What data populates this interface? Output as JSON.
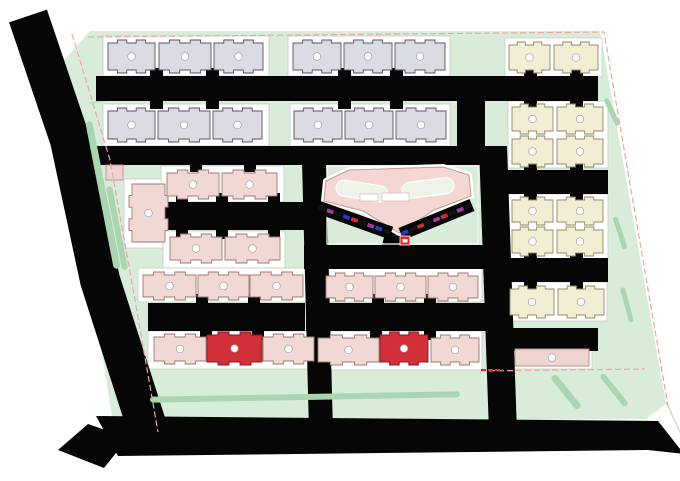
{
  "canvas": {
    "width": 680,
    "height": 481,
    "background": "#ffffff"
  },
  "palette": {
    "road": "#060606",
    "site_green": "#d9ecda",
    "hedge": "#a9d6b1",
    "hedge_light": "#c2e3c8",
    "pad_fill": "#ffffff",
    "pad_stroke": "#c9cdc9",
    "school_fill": "#f4d6d2",
    "school_stroke": "#c09a94",
    "courtyard_fill": "#edf2eb",
    "panel_frame": "#f2f6f1",
    "boundary_pink": "#e9a7a1",
    "marker_red": "#e8242b",
    "dash_red": "#e03038",
    "label_ring": "#9b9ba3"
  },
  "site": {
    "types": {
      "gray": {
        "fill": "#dbdbe3",
        "stroke": "#55555f"
      },
      "cream": {
        "fill": "#f2eed3",
        "stroke": "#8d8a68"
      },
      "pink": {
        "fill": "#f1d8d5",
        "stroke": "#9b7a76"
      },
      "red": {
        "fill": "#d13038",
        "stroke": "#7e1d24"
      },
      "flat_pink": {
        "fill": "#f0d4d1",
        "stroke": "#b5928e"
      }
    },
    "buildings": [
      {
        "x": 108,
        "y": 40,
        "w": 47,
        "h": 33,
        "type": "gray"
      },
      {
        "x": 159,
        "y": 40,
        "w": 52,
        "h": 33,
        "type": "gray"
      },
      {
        "x": 214,
        "y": 40,
        "w": 49,
        "h": 33,
        "type": "gray"
      },
      {
        "x": 293,
        "y": 40,
        "w": 48,
        "h": 33,
        "type": "gray"
      },
      {
        "x": 344,
        "y": 40,
        "w": 48,
        "h": 33,
        "type": "gray"
      },
      {
        "x": 395,
        "y": 40,
        "w": 50,
        "h": 33,
        "type": "gray"
      },
      {
        "x": 108,
        "y": 108,
        "w": 47,
        "h": 34,
        "type": "gray"
      },
      {
        "x": 158,
        "y": 108,
        "w": 52,
        "h": 34,
        "type": "gray"
      },
      {
        "x": 213,
        "y": 108,
        "w": 49,
        "h": 34,
        "type": "gray"
      },
      {
        "x": 294,
        "y": 108,
        "w": 48,
        "h": 34,
        "type": "gray"
      },
      {
        "x": 345,
        "y": 108,
        "w": 48,
        "h": 34,
        "type": "gray"
      },
      {
        "x": 396,
        "y": 108,
        "w": 50,
        "h": 34,
        "type": "gray"
      },
      {
        "x": 509,
        "y": 42,
        "w": 41,
        "h": 31,
        "type": "cream"
      },
      {
        "x": 554,
        "y": 42,
        "w": 44,
        "h": 31,
        "type": "cream"
      },
      {
        "x": 512,
        "y": 104,
        "w": 41,
        "h": 30,
        "type": "cream"
      },
      {
        "x": 557,
        "y": 104,
        "w": 46,
        "h": 30,
        "type": "cream"
      },
      {
        "x": 512,
        "y": 136,
        "w": 41,
        "h": 31,
        "type": "cream"
      },
      {
        "x": 557,
        "y": 136,
        "w": 46,
        "h": 31,
        "type": "cream"
      },
      {
        "x": 512,
        "y": 197,
        "w": 41,
        "h": 28,
        "type": "cream"
      },
      {
        "x": 557,
        "y": 197,
        "w": 46,
        "h": 28,
        "type": "cream"
      },
      {
        "x": 512,
        "y": 227,
        "w": 41,
        "h": 29,
        "type": "cream"
      },
      {
        "x": 557,
        "y": 227,
        "w": 46,
        "h": 29,
        "type": "cream"
      },
      {
        "x": 510,
        "y": 286,
        "w": 44,
        "h": 32,
        "type": "cream"
      },
      {
        "x": 558,
        "y": 286,
        "w": 46,
        "h": 32,
        "type": "cream"
      },
      {
        "x": 129,
        "y": 184,
        "w": 39,
        "h": 58,
        "type": "pink",
        "orient": "v"
      },
      {
        "x": 167,
        "y": 170,
        "w": 52,
        "h": 29,
        "type": "pink"
      },
      {
        "x": 222,
        "y": 170,
        "w": 55,
        "h": 29,
        "type": "pink"
      },
      {
        "x": 170,
        "y": 234,
        "w": 52,
        "h": 29,
        "type": "pink"
      },
      {
        "x": 225,
        "y": 234,
        "w": 55,
        "h": 29,
        "type": "pink"
      },
      {
        "x": 106,
        "y": 165,
        "w": 17,
        "h": 15,
        "type": "flat_pink",
        "flat": true,
        "label": false
      },
      {
        "x": 143,
        "y": 272,
        "w": 53,
        "h": 28,
        "type": "pink"
      },
      {
        "x": 198,
        "y": 272,
        "w": 51,
        "h": 28,
        "type": "pink"
      },
      {
        "x": 250,
        "y": 272,
        "w": 53,
        "h": 28,
        "type": "pink"
      },
      {
        "x": 154,
        "y": 334,
        "w": 52,
        "h": 30,
        "type": "pink"
      },
      {
        "x": 207,
        "y": 332,
        "w": 55,
        "h": 33,
        "type": "red"
      },
      {
        "x": 263,
        "y": 334,
        "w": 51,
        "h": 30,
        "type": "pink"
      },
      {
        "x": 326,
        "y": 273,
        "w": 47,
        "h": 28,
        "type": "pink"
      },
      {
        "x": 375,
        "y": 273,
        "w": 51,
        "h": 28,
        "type": "pink"
      },
      {
        "x": 428,
        "y": 273,
        "w": 50,
        "h": 28,
        "type": "pink"
      },
      {
        "x": 318,
        "y": 335,
        "w": 61,
        "h": 30,
        "type": "pink"
      },
      {
        "x": 380,
        "y": 332,
        "w": 48,
        "h": 33,
        "type": "red"
      },
      {
        "x": 431,
        "y": 335,
        "w": 48,
        "h": 30,
        "type": "pink"
      },
      {
        "x": 515,
        "y": 349,
        "w": 74,
        "h": 17,
        "type": "flat_pink",
        "flat": true
      }
    ],
    "parking": [
      {
        "x1": 318,
        "y1": 207,
        "x2": 391,
        "y2": 233,
        "cars": [
          "#111118",
          "#a23a9c",
          "#111118",
          "#2a39c6",
          "#d62b33",
          "#111118",
          "#a23a9c",
          "#2a39c6",
          "#111118"
        ]
      },
      {
        "x1": 401,
        "y1": 234,
        "x2": 472,
        "y2": 205,
        "cars": [
          "#2a39c6",
          "#111118",
          "#d62b33",
          "#111118",
          "#a23a9c",
          "#d62b33",
          "#111118",
          "#a23a9c",
          "#111118"
        ]
      }
    ],
    "hedges": [
      {
        "cx": 103,
        "cy": 195,
        "w": 7,
        "h": 150,
        "rot": -11
      },
      {
        "cx": 117,
        "cy": 228,
        "w": 6,
        "h": 85,
        "rot": -11
      },
      {
        "cx": 305,
        "cy": 397,
        "w": 310,
        "h": 6,
        "rot": -1
      },
      {
        "cx": 566,
        "cy": 392,
        "w": 7,
        "h": 42,
        "rot": -39
      },
      {
        "cx": 614,
        "cy": 390,
        "w": 6,
        "h": 40,
        "rot": -39
      },
      {
        "cx": 612,
        "cy": 112,
        "w": 5,
        "h": 30,
        "rot": -25
      },
      {
        "cx": 620,
        "cy": 233,
        "w": 5,
        "h": 34,
        "rot": -18
      },
      {
        "cx": 627,
        "cy": 305,
        "w": 5,
        "h": 36,
        "rot": -15
      }
    ]
  }
}
